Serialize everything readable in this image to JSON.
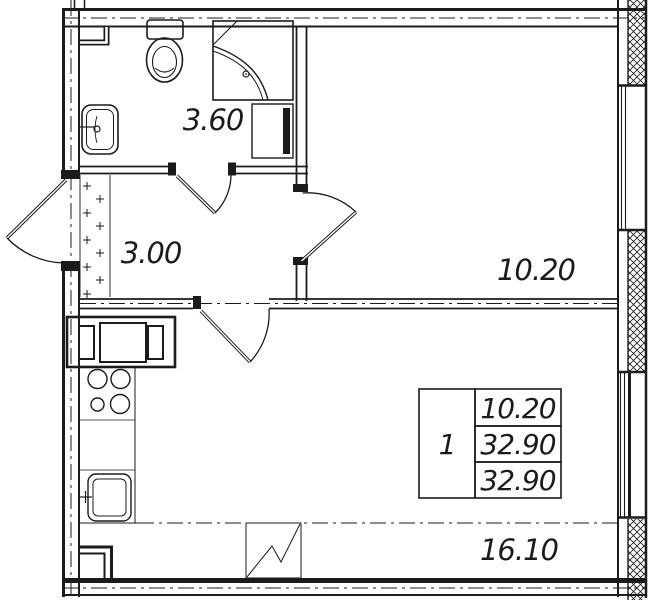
{
  "plan": {
    "title": "one-room apartment floor plan",
    "colors": {
      "line": "#1b1b1b",
      "background": "#ffffff"
    },
    "rooms": {
      "bathroom": {
        "area": "3.60"
      },
      "hall": {
        "area": "3.00"
      },
      "living_room": {
        "area": "10.20"
      },
      "kitchen_living": {
        "area": "16.10"
      }
    },
    "info_table": {
      "number": "1",
      "rows": [
        "10.20",
        "32.90",
        "32.90"
      ]
    },
    "icons": [
      "toilet",
      "shower-cabin",
      "washbasin",
      "washing-machine",
      "sofa",
      "stove-burners",
      "kitchen-sink",
      "ventilation-shaft",
      "entrance-door",
      "bathroom-door",
      "living-room-door",
      "kitchen-door",
      "window",
      "balcony-zigzag"
    ]
  }
}
